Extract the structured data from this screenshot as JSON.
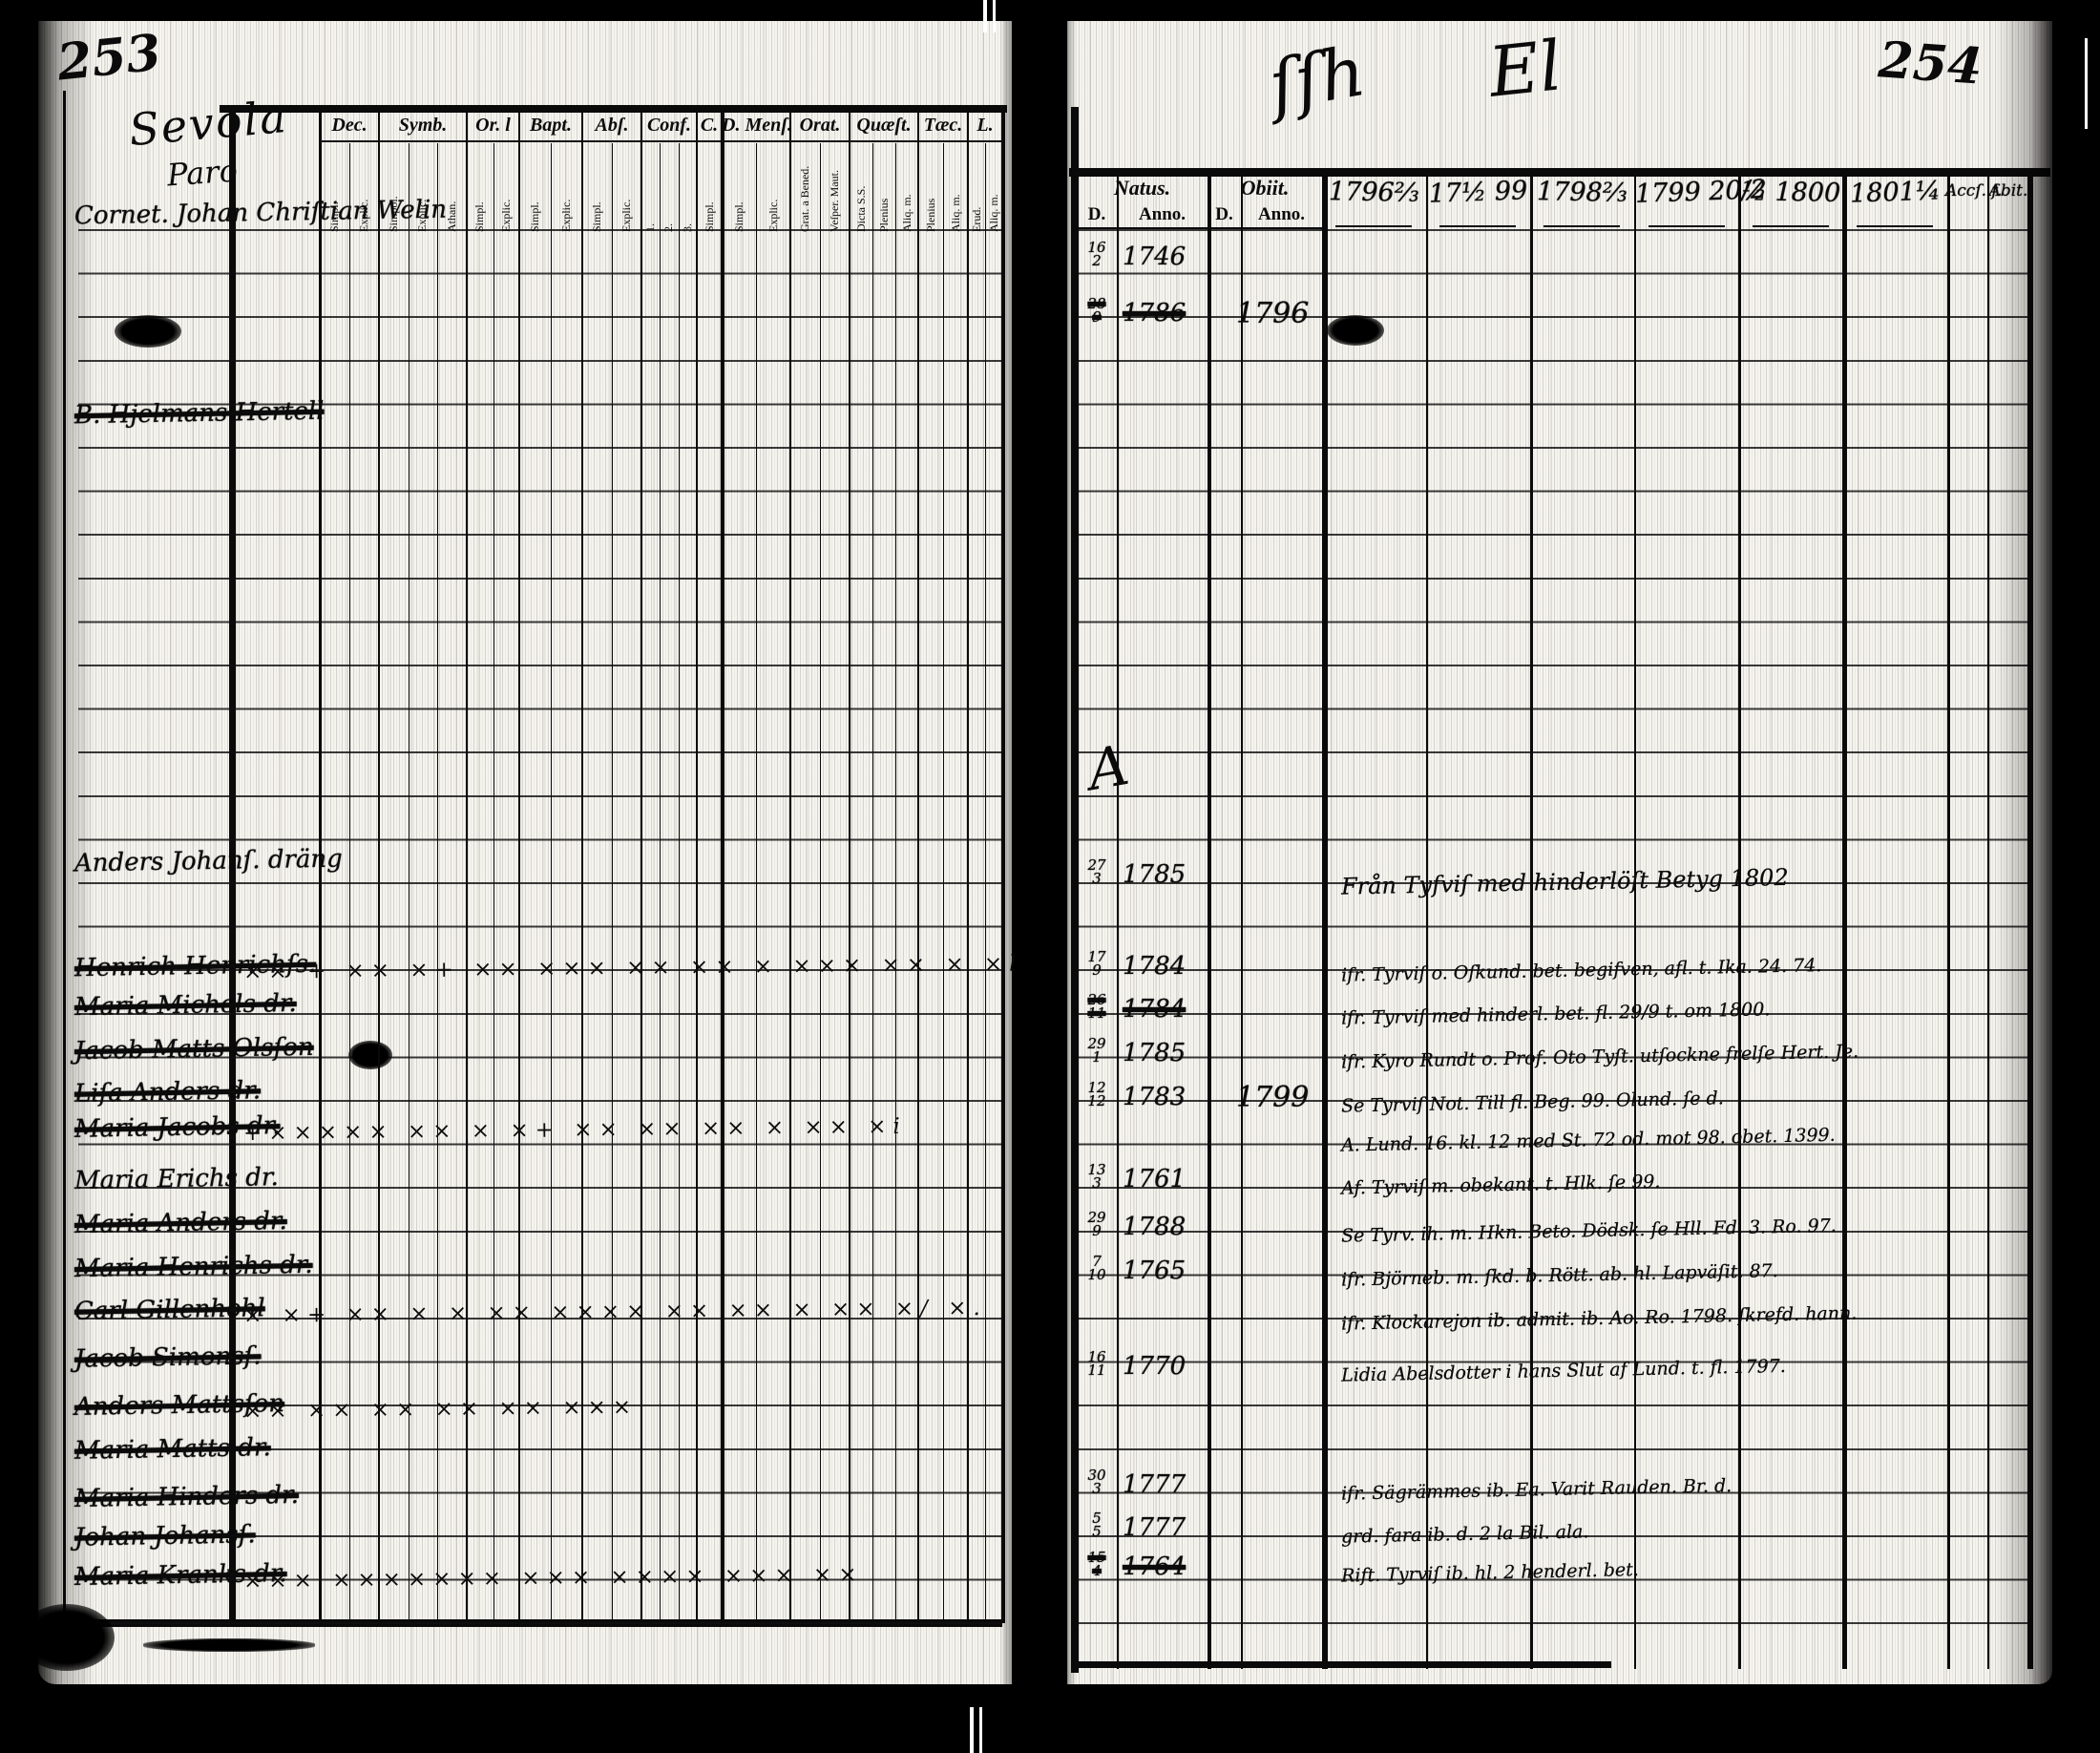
{
  "scan": {
    "left_page_number": "253",
    "right_page_number": "254",
    "gutter_mark_1": "ſſh",
    "gutter_mark_2": "El",
    "margin_mark": "A"
  },
  "left_page": {
    "parish_line1": "Sevola",
    "parish_line2": "Paro",
    "header_groups": [
      {
        "label": "Dec.",
        "subs": [
          "Simpl.",
          "Explic."
        ]
      },
      {
        "label": "Symb.",
        "subs": [
          "Simpol.",
          "Explic.",
          "Athan."
        ]
      },
      {
        "label": "Or. l",
        "subs": [
          "Simpl.",
          "Explic."
        ]
      },
      {
        "label": "Bapt.",
        "subs": [
          "Simpl.",
          "Explic."
        ]
      },
      {
        "label": "Abſ.",
        "subs": [
          "Simpl.",
          "Explic."
        ]
      },
      {
        "label": "Conf.",
        "subs": [
          "1.",
          "2.",
          "3."
        ]
      },
      {
        "label": "C.",
        "subs": [
          "Simpl."
        ]
      },
      {
        "label": "D. Menſ.",
        "subs": [
          "Simpl.",
          "Explic."
        ]
      },
      {
        "label": "Orat.",
        "subs": [
          "Grat. a Bened.",
          "Veſper. Maut."
        ]
      },
      {
        "label": "Quæſt.",
        "subs": [
          "Dicta S.S.",
          "Plenius",
          "Aliq. m."
        ]
      },
      {
        "label": "Tæc.",
        "subs": [
          "Plenius",
          "Aliq. m."
        ]
      },
      {
        "label": "L.",
        "subs": [
          "Erud.",
          "Aliq. m."
        ]
      }
    ],
    "entries": [
      {
        "row": 0.0,
        "name": "Cornet. Johan Chriſtian Welin",
        "struck": false,
        "marks": ""
      },
      {
        "row": 4.6,
        "name": "B. Hjelmans Hertell",
        "struck": true,
        "marks": ""
      },
      {
        "row": 14.9,
        "name": "Anders Johanſ. dräng",
        "struck": false,
        "marks": ""
      },
      {
        "row": 17.3,
        "name": "Henrich Henrichſs.",
        "struck": true,
        "marks": "×× + ×× ×+ ×× ××× ×× ×× × ××× ×× × ×l"
      },
      {
        "row": 18.2,
        "name": "Maria Michels dr.",
        "struck": true,
        "marks": ""
      },
      {
        "row": 19.2,
        "name": "Jacob Matts Olsſon",
        "struck": true,
        "marks": ""
      },
      {
        "row": 20.2,
        "name": "Liſa Anders dr.",
        "struck": true,
        "marks": ""
      },
      {
        "row": 21.0,
        "name": "Maria Jacobs dr.",
        "struck": true,
        "marks": "+××××× ×× × ×+ ×× ×× ×× × ×× ×i"
      },
      {
        "row": 22.2,
        "name": "Maria Erichs dr.",
        "struck": false,
        "marks": ""
      },
      {
        "row": 23.2,
        "name": "Maria Anders dr.",
        "struck": true,
        "marks": ""
      },
      {
        "row": 24.2,
        "name": "Maria Henrichs dr.",
        "struck": true,
        "marks": ""
      },
      {
        "row": 25.2,
        "name": "Carl Gillenhohl",
        "struck": true,
        "marks": "× ×+ ×× × × ×× ×××× ×× ×× × ×× ×/ ×."
      },
      {
        "row": 26.3,
        "name": "Jacob Simonsſ.",
        "struck": true,
        "marks": ""
      },
      {
        "row": 27.4,
        "name": "Anders Mattsſon",
        "struck": true,
        "marks": "×× ×× ×× ×× ×× ×××"
      },
      {
        "row": 28.4,
        "name": "Maria Matts dr.",
        "struck": true,
        "marks": ""
      },
      {
        "row": 29.5,
        "name": "Maria Hinders dr.",
        "struck": true,
        "marks": ""
      },
      {
        "row": 30.4,
        "name": "Johan Johansſ.",
        "struck": true,
        "marks": ""
      },
      {
        "row": 31.3,
        "name": "Maria Kranks dr.",
        "struck": true,
        "marks": "××× ××××××× ××× ×××× ××× ××"
      }
    ]
  },
  "right_page": {
    "col_natus": "Natus.",
    "col_obiit": "Obiit.",
    "sub_cells": [
      "D.",
      "Anno.",
      "D.",
      "Anno."
    ],
    "year_columns": [
      "1796⅔",
      "17½ 99",
      "1798⅔",
      "1799 20/2",
      "½ 1800",
      "1801¼"
    ],
    "tail_columns": [
      "Accſ. f.",
      "Abit."
    ],
    "entries": [
      {
        "row": 1.0,
        "day": "16/2",
        "year": "1746",
        "struck": false,
        "obiit_year": "",
        "remark": ""
      },
      {
        "row": 2.3,
        "day": "28/9",
        "year": "1786",
        "struck": true,
        "obiit_year": "1796",
        "remark": ""
      },
      {
        "row": 15.2,
        "day": "27/3",
        "year": "1785",
        "struck": false,
        "obiit_year": "",
        "remark": "Från Tyfviſ med hinderlöſt Betyg 1802"
      },
      {
        "row": 17.3,
        "day": "17/9",
        "year": "1784",
        "struck": false,
        "obiit_year": "",
        "remark": "ifr. Tyrviſ o. Oſkund. bet. begifven, afl. t. Ika. 24. 74."
      },
      {
        "row": 18.3,
        "day": "26/11",
        "year": "1784",
        "struck": true,
        "obiit_year": "",
        "remark": "ifr. Tyrviſ med hinderl. bet. fl. 29/9 t. om 1800."
      },
      {
        "row": 19.3,
        "day": "29/1",
        "year": "1785",
        "struck": false,
        "obiit_year": "",
        "remark": "ifr. Kyro Rundt o. Prof. Oto Tyſt. utſockne frelſe Hert. Je."
      },
      {
        "row": 20.3,
        "day": "12/12",
        "year": "1783",
        "struck": false,
        "obiit_year": "1799",
        "remark": "Se Tyrviſ Not. Till fl. Beg. 99. Olund. ſe d."
      },
      {
        "row": 21.2,
        "day": "",
        "year": "",
        "struck": false,
        "obiit_year": "",
        "remark": "A. Lund. 16. kl. 12 med St. 72 od. mot 98. obet. 1399."
      },
      {
        "row": 22.2,
        "day": "13/3",
        "year": "1761",
        "struck": false,
        "obiit_year": "",
        "remark": "Af. Tyrviſ m. obekant. t. Hlk. ſe 99."
      },
      {
        "row": 23.3,
        "day": "29/9",
        "year": "1788",
        "struck": false,
        "obiit_year": "",
        "remark": "Se Tyrv. ih. m. Hkn. Beto. Dödsk. ſe Hll. Fd. 3. Ro. 97."
      },
      {
        "row": 24.3,
        "day": "7/10",
        "year": "1765",
        "struck": false,
        "obiit_year": "",
        "remark": "ifr. Björneb. m. ſkd. b. Rött. ab. hl. Lapväſit. 87."
      },
      {
        "row": 25.3,
        "day": "",
        "year": "",
        "struck": false,
        "obiit_year": "",
        "remark": "ifr. Klockarejon ib. admit. ib. Ao. Ro. 1798. ſkrefd. hann."
      },
      {
        "row": 26.5,
        "day": "16/11",
        "year": "1770",
        "struck": false,
        "obiit_year": "",
        "remark": "Lidia Abelsdotter i hans Slut af Lund. t. fl. 1797."
      },
      {
        "row": 29.2,
        "day": "30/3",
        "year": "1777",
        "struck": false,
        "obiit_year": "",
        "remark": "ifr. Sägrämmes ib. Ea. Varit Rauden. Br. d."
      },
      {
        "row": 30.2,
        "day": "5/5",
        "year": "1777",
        "struck": false,
        "obiit_year": "",
        "remark": "grd. fara ib. d. 2 la Bil. ala."
      },
      {
        "row": 31.1,
        "day": "15/4",
        "year": "1764",
        "struck": true,
        "obiit_year": "",
        "remark": "Rift. Tyrviſ ib. hl. 2 henderl. bet."
      }
    ]
  }
}
